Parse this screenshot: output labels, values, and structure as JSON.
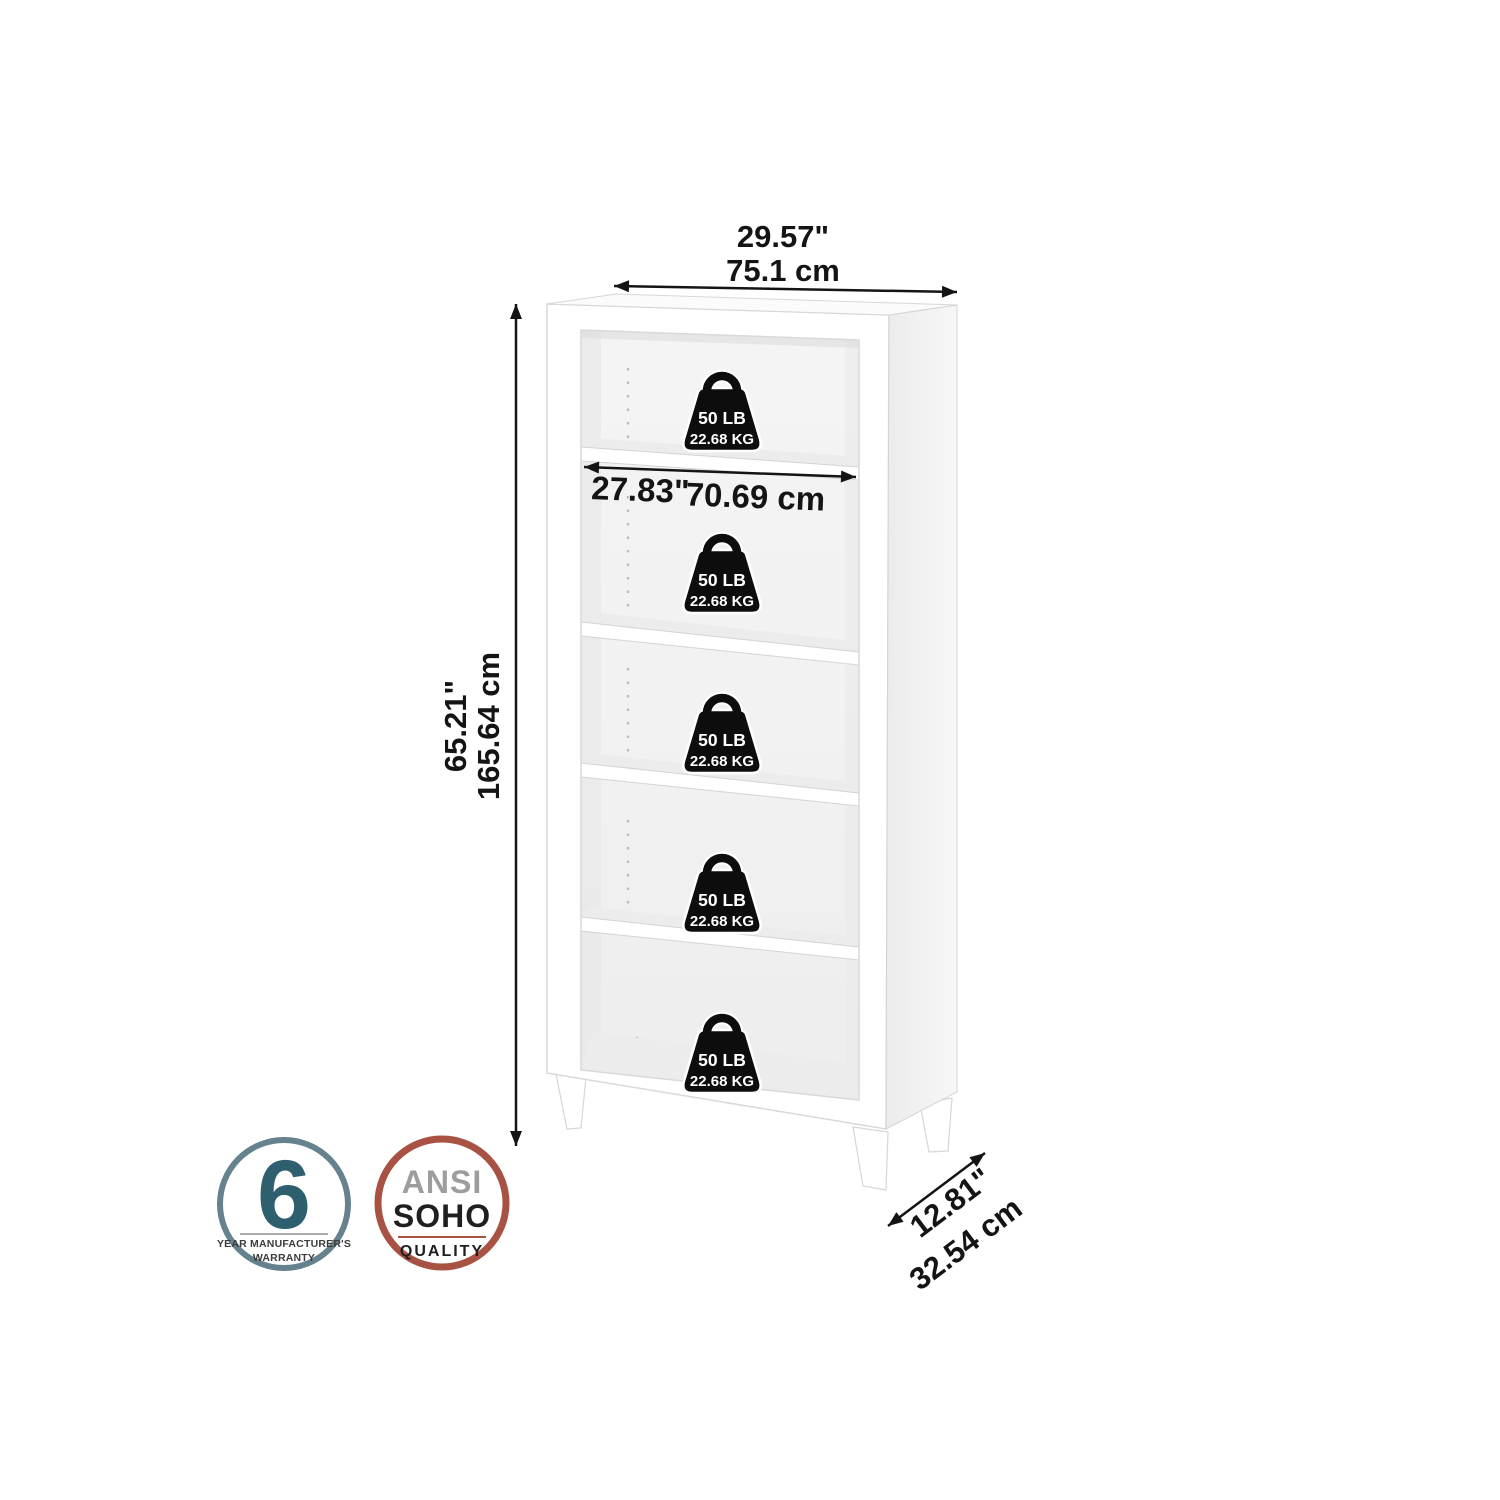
{
  "diagram": {
    "overall_width": {
      "inches": "29.57\"",
      "centimeters": "75.1 cm"
    },
    "overall_height": {
      "inches": "65.21\"",
      "centimeters": "165.64 cm"
    },
    "shelf_width": {
      "inches": "27.83\"",
      "centimeters": "70.69 cm"
    },
    "overall_depth": {
      "inches": "12.81\"",
      "centimeters": "32.54 cm"
    },
    "shelf_capacity": {
      "pounds": "50 LB",
      "kilograms": "22.68 KG"
    }
  },
  "badges": {
    "warranty": {
      "years": "6",
      "line1": "YEAR MANUFACTURER'S",
      "line2": "WARRANTY"
    },
    "quality": {
      "line1": "ANSI",
      "line2": "SOHO",
      "line3": "QUALITY"
    }
  },
  "colors": {
    "ink": "#141414",
    "warranty_ring": "#66828e",
    "warranty_number": "#2e5f6e",
    "warranty_text": "#3c3c3c",
    "quality_ring": "#a85243",
    "quality_ansi": "#9d9d9d",
    "quality_text": "#1f1f1f",
    "weight_icon_fill": "#0d0d0d",
    "weight_icon_text": "#ffffff"
  }
}
